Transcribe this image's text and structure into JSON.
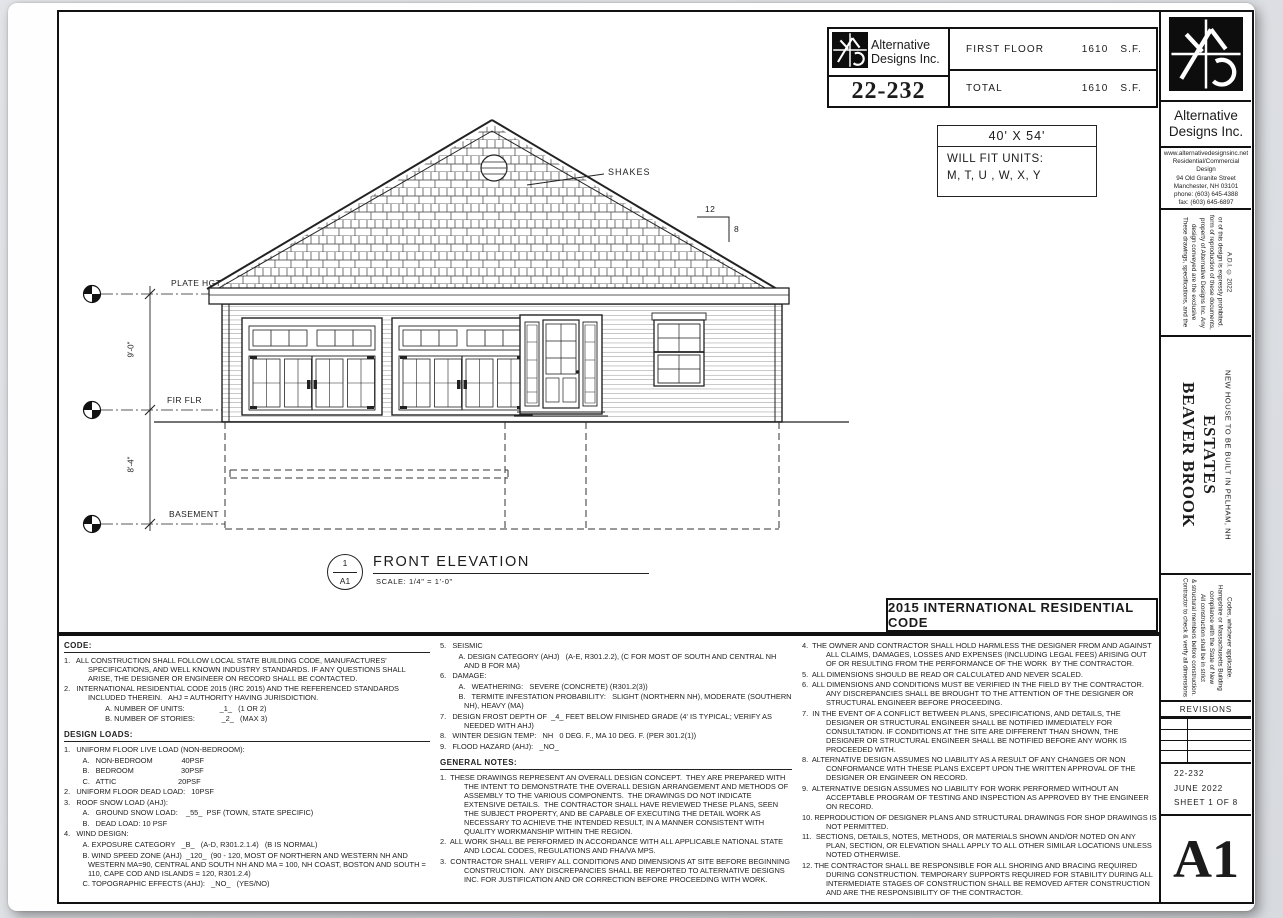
{
  "titleblock": {
    "company_line1": "Alternative",
    "company_line2": "Designs Inc.",
    "project_number": "22-232",
    "rows": [
      {
        "label": "FIRST FLOOR",
        "value": "1610",
        "unit": "S.F."
      },
      {
        "label": "TOTAL",
        "value": "1610",
        "unit": "S.F."
      }
    ]
  },
  "fitbox": {
    "size": "40' X 54'",
    "line1": "WILL FIT UNITS:",
    "line2": "M, T, U , W, X, Y"
  },
  "elevation": {
    "shakes_label": "SHAKES",
    "pitch_run": "12",
    "pitch_rise": "8",
    "plate_label": "PLATE HGT",
    "first_floor_label": "FIR FLR",
    "basement_label": "BASEMENT",
    "dim_upper": "9'-0\"",
    "dim_lower": "8'-4\"",
    "view_number": "1",
    "view_sheet": "A1",
    "view_title": "FRONT ELEVATION",
    "view_scale": "SCALE:  1/4\" = 1'-0\""
  },
  "code_banner": "2015 INTERNATIONAL RESIDENTIAL CODE",
  "notes": {
    "code_heading": "CODE:",
    "code_items": [
      "1.   ALL CONSTRUCTION SHALL FOLLOW LOCAL STATE BUILDING CODE, MANUFACTURES' SPECIFICATIONS, AND WELL KNOWN INDUSTRY STANDARDS. IF ANY QUESTIONS SHALL ARISE, THE DESIGNER OR ENGINEER ON RECORD SHALL BE CONTACTED.",
      "2.   INTERNATIONAL RESIDENTIAL CODE 2015 (IRC 2015) AND THE REFERENCED STANDARDS INCLUDED THEREIN.   AHJ = AUTHORITY HAVING JURISDICTION.",
      "                    A. NUMBER OF UNITS:                 _1_   (1 OR 2)",
      "                    B. NUMBER OF STORIES:             _2_   (MAX 3)"
    ],
    "design_loads_heading": "DESIGN LOADS:",
    "design_loads_items": [
      "1.   UNIFORM FLOOR LIVE LOAD (NON-BEDROOM):",
      "         A.   NON-BEDROOM              40PSF",
      "         B.   BEDROOM                       30PSF",
      "         C.   ATTIC                              20PSF",
      "2.   UNIFORM FLOOR DEAD LOAD:   10PSF",
      "3.   ROOF SNOW LOAD (AHJ):",
      "         A.   GROUND SNOW LOAD:    _55_  PSF (TOWN, STATE SPECIFIC)",
      "         B.   DEAD LOAD: 10 PSF",
      "4.   WIND DESIGN:",
      "         A. EXPOSURE CATEGORY   _B_   (A-D, R301.2.1.4)   (B IS NORMAL)",
      "         B. WIND SPEED ZONE (AHJ)  _120_  (90 - 120, MOST OF NORTHERN AND WESTERN NH AND WESTERN MA=90, CENTRAL AND SOUTH NH AND MA = 100, NH COAST, BOSTON AND SOUTH = 110, CAPE COD AND ISLANDS = 120, R301.2.4)",
      "         C. TOPOGRAPHIC EFFECTS (AHJ):   _NO_   (YES/NO)"
    ],
    "col2_items": [
      "5.   SEISMIC",
      "         A. DESIGN CATEGORY (AHJ)   (A-E, R301.2.2), (C FOR MOST OF SOUTH AND CENTRAL NH AND B FOR MA)",
      "6.   DAMAGE:",
      "         A.   WEATHERING:   SEVERE (CONCRETE) (R301.2(3))",
      "         B.   TERMITE INFESTATION PROBABILITY:   SLIGHT (NORTHERN NH), MODERATE (SOUTHERN NH), HEAVY (MA)",
      "7.   DESIGN FROST DEPTH OF  _4_ FEET BELOW FINISHED GRADE (4' IS TYPICAL; VERIFY AS NEEDED WITH AHJ)",
      "8.   WINTER DESIGN TEMP:   NH   0 DEG. F., MA 10 DEG. F. (PER 301.2(1))",
      "9.   FLOOD HAZARD (AHJ):   _NO_"
    ],
    "general_heading": "GENERAL NOTES:",
    "general_items": [
      "1.  THESE DRAWINGS REPRESENT AN OVERALL DESIGN CONCEPT.  THEY ARE PREPARED WITH THE INTENT TO DEMONSTRATE THE OVERALL DESIGN ARRANGEMENT AND METHODS OF ASSEMBLY TO THE VARIOUS COMPONENTS.  THE DRAWINGS DO NOT INDICATE EXTENSIVE DETAILS.  THE CONTRACTOR SHALL HAVE REVIEWED THESE PLANS, SEEN THE SUBJECT PROPERTY, AND BE CAPABLE OF EXECUTING THE DETAIL WORK AS NECESSARY TO ACHIEVE THE INTENDED RESULT, IN A MANNER CONSISTENT WITH QUALITY WORKMANSHIP WITHIN THE REGION.",
      "2.  ALL WORK SHALL BE PERFORMED IN ACCORDANCE WITH ALL APPLICABLE NATIONAL STATE AND LOCAL CODES, REGULATIONS AND FHA/VA MPS.",
      "3.  CONTRACTOR SHALL VERIFY ALL CONDITIONS AND DIMENSIONS AT SITE BEFORE BEGINNING CONSTRUCTION.  ANY DISCREPANCIES SHALL BE REPORTED TO ALTERNATIVE DESIGNS INC. FOR JUSTIFICATION AND OR CORRECTION BEFORE PROCEEDING WITH WORK."
    ],
    "col3_items": [
      "4.  THE OWNER AND CONTRACTOR SHALL HOLD HARMLESS THE DESIGNER FROM AND AGAINST ALL CLAIMS, DAMAGES, LOSSES AND EXPENSES (INCLUDING LEGAL FEES) ARISING OUT OF OR RESULTING FROM THE PERFORMANCE OF THE WORK  BY THE CONTRACTOR.",
      "5.  ALL DIMENSIONS SHOULD BE READ OR CALCULATED AND NEVER SCALED.",
      "6.  ALL DIMENSIONS AND CONDITIONS MUST BE VERIFIED IN THE FIELD BY THE CONTRACTOR. ANY DISCREPANCIES SHALL BE BROUGHT TO THE ATTENTION OF THE DESIGNER OR STRUCTURAL ENGINEER BEFORE PROCEEDING.",
      "7.  IN THE EVENT OF A CONFLICT BETWEEN PLANS, SPECIFICATIONS, AND DETAILS, THE DESIGNER OR STRUCTURAL ENGINEER SHALL BE NOTIFIED IMMEDIATELY FOR CONSULTATION. IF CONDITIONS AT THE SITE ARE DIFFERENT THAN SHOWN, THE DESIGNER OR STRUCTURAL ENGINEER SHALL BE NOTIFIED BEFORE ANY WORK IS PROCEEDED WITH.",
      "8.  ALTERNATIVE DESIGN ASSUMES NO LIABILITY AS A RESULT OF ANY CHANGES OR NON CONFORMANCE WITH THESE PLANS EXCEPT UPON THE WRITTEN APPROVAL OF THE DESIGNER OR ENGINEER ON RECORD.",
      "9.  ALTERNATIVE DESIGN ASSUMES NO LIABILITY FOR WORK PERFORMED WITHOUT AN ACCEPTABLE PROGRAM OF TESTING AND INSPECTION AS APPROVED BY THE ENGINEER ON RECORD.",
      "10. REPRODUCTION OF DESIGNER PLANS AND STRUCTURAL DRAWINGS FOR SHOP DRAWINGS IS NOT PERMITTED.",
      "11.  SECTIONS, DETAILS, NOTES, METHODS, OR MATERIALS SHOWN AND/OR NOTED ON ANY PLAN, SECTION, OR ELEVATION SHALL APPLY TO ALL OTHER SIMILAR LOCATIONS UNLESS NOTED OTHERWISE.",
      "12. THE CONTRACTOR SHALL BE RESPONSIBLE FOR ALL SHORING AND BRACING REQUIRED DURING CONSTRUCTION. TEMPORARY SUPPORTS REQUIRED FOR STABILITY DURING ALL INTERMEDIATE STAGES OF CONSTRUCTION SHALL BE REMOVED AFTER CONSTRUCTION AND ARE THE RESPONSIBILITY OF THE CONTRACTOR."
    ]
  },
  "sidebar": {
    "company_line1": "Alternative",
    "company_line2": "Designs Inc.",
    "info_lines": [
      "www.alternativedesignsinc.net",
      "Residential/Commercial",
      "Design",
      "94 Old Granite Street",
      "Manchester, NH 03101",
      "phone: (603) 645-4388",
      "fax: (603) 645-6897"
    ],
    "copyright": "These drawings, specifications, and the design conveyed are the exclusive property of Alternative Designs Inc. Any form of reproduction of these documents, or of this design is expressly prohibited. A.D.I. © 2022",
    "project_title": "BEAVER BROOK ESTATES",
    "project_subtitle": "NEW HOUSE TO BE BUILT IN PELHAM, NH",
    "contractor_note": "Contractor to check & verify all dimensions & structural members before construction. All construction shall be in strict compliance with the State of New Hampshire or Massachusetts Building Codes, whichever applicable.",
    "revisions_label": "REVISIONS",
    "stamp_lines": [
      "22-232",
      "JUNE 2022",
      "SHEET 1 OF 8"
    ],
    "sheet_id": "A1"
  }
}
